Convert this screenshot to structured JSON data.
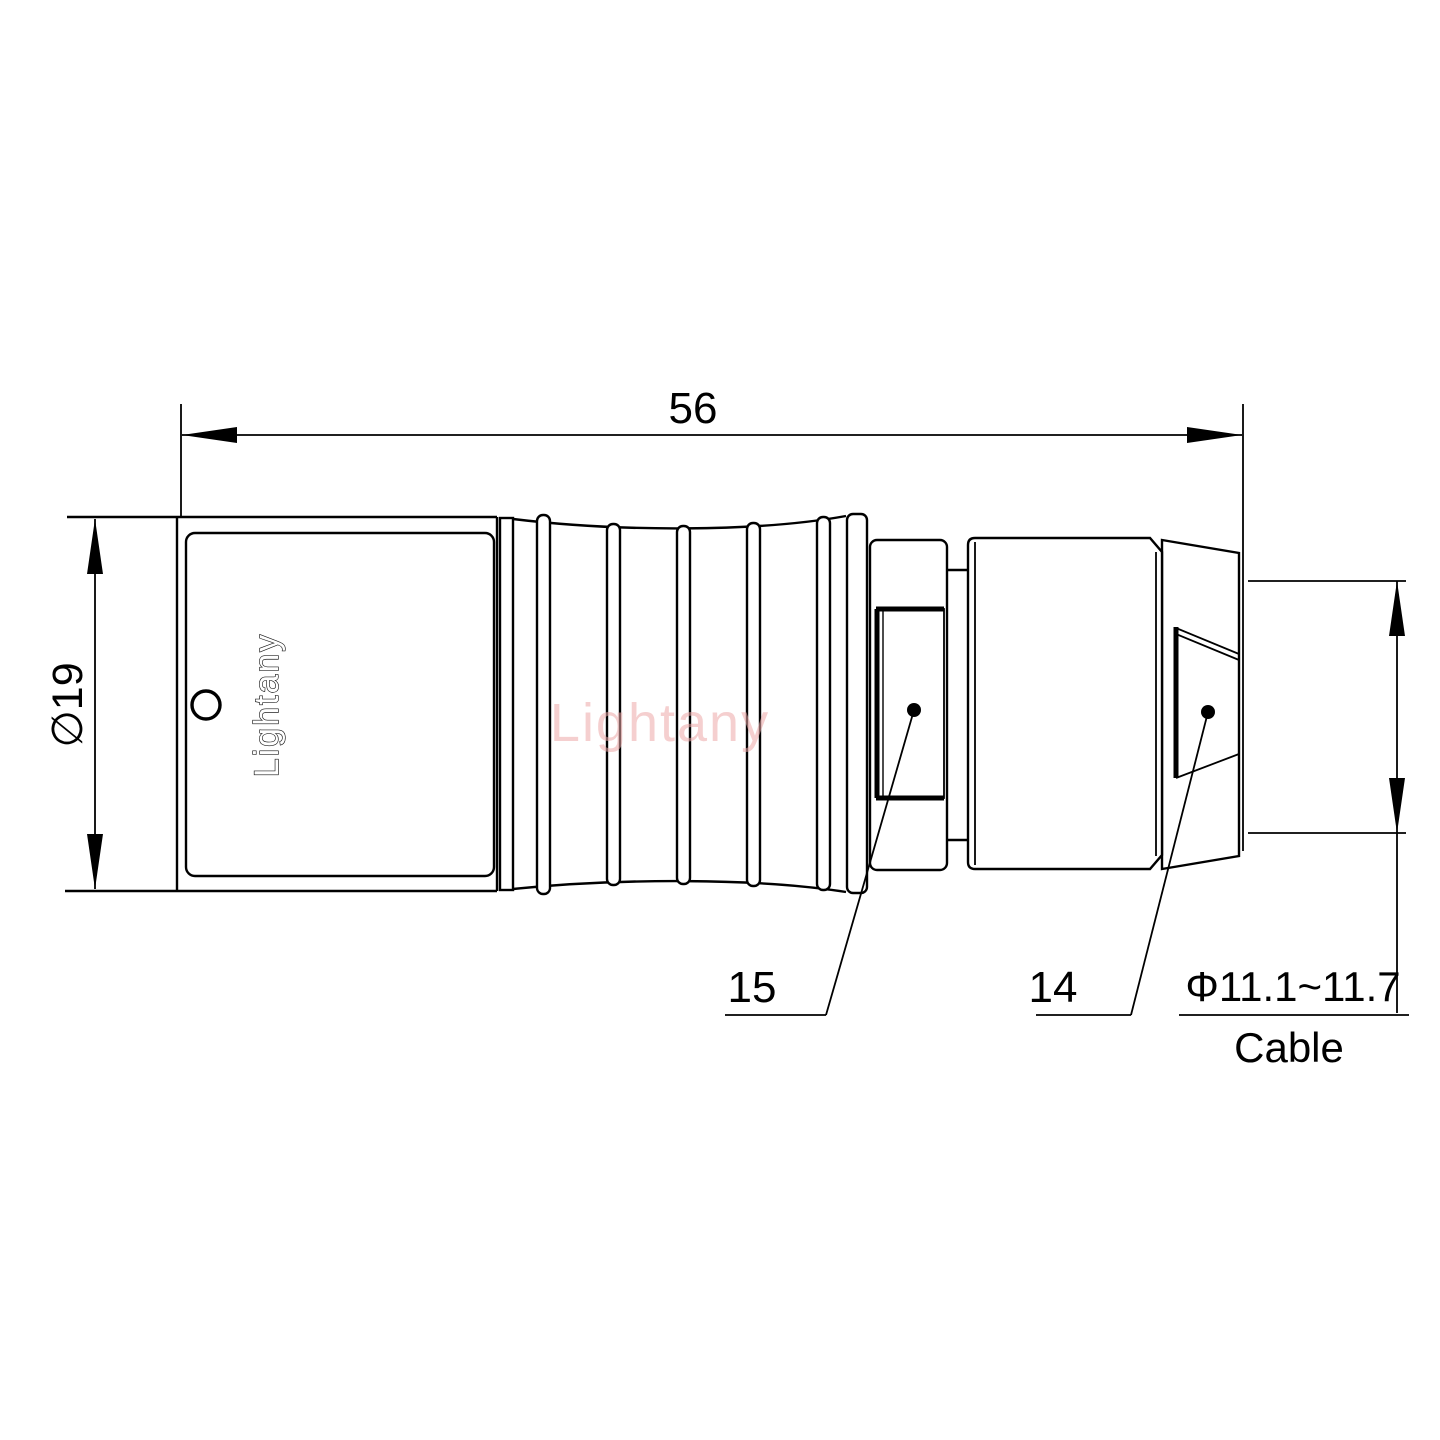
{
  "drawing": {
    "watermark": "Lightany",
    "engraving": "Lightany",
    "dimensions": {
      "overall_length": "56",
      "body_diameter": "∅19",
      "cable_range": "Φ11.1~11.7",
      "cable_label": "Cable"
    },
    "part_labels": {
      "collet": "15",
      "nut": "14"
    },
    "colors": {
      "line": "#000000",
      "watermark": "#eda9a9"
    }
  }
}
